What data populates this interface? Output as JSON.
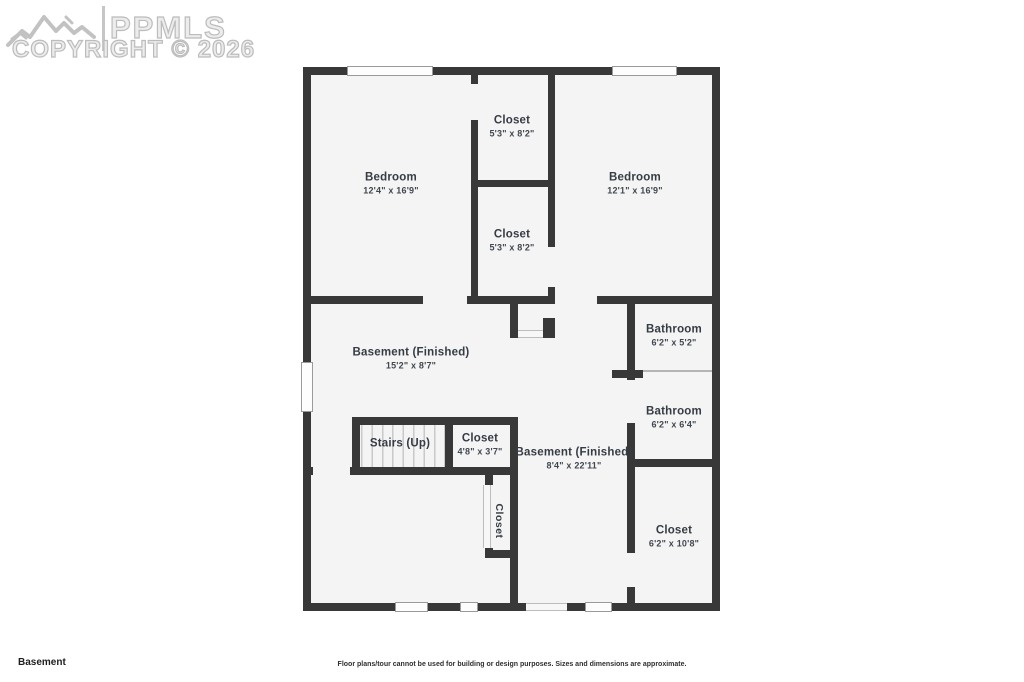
{
  "watermark": {
    "brand": "PPMLS",
    "copyright": "COPYRIGHT © 2026"
  },
  "floor_label": "Basement",
  "disclaimer": "Floor plans/tour cannot be used for building or design purposes. Sizes and dimensions are approximate.",
  "colors": {
    "wall": "#383838",
    "floor": "#f4f4f4",
    "label_text": "#363c44",
    "watermark": "#bcbcbc"
  },
  "rooms": [
    {
      "name": "Bedroom",
      "dims": "12'4\" x 16'9\""
    },
    {
      "name": "Closet",
      "dims": "5'3\" x 8'2\""
    },
    {
      "name": "Closet",
      "dims": "5'3\" x 8'2\""
    },
    {
      "name": "Bedroom",
      "dims": "12'1\" x 16'9\""
    },
    {
      "name": "Basement (Finished)",
      "dims": "15'2\" x 8'7\""
    },
    {
      "name": "Bathroom",
      "dims": "6'2\" x 5'2\""
    },
    {
      "name": "Bathroom",
      "dims": "6'2\" x 6'4\""
    },
    {
      "name": "Stairs (Up)",
      "dims": ""
    },
    {
      "name": "Closet",
      "dims": "4'8\" x 3'7\""
    },
    {
      "name": "Basement (Finished)",
      "dims": "8'4\" x 22'11\""
    },
    {
      "name": "Closet",
      "dims": "6'2\" x 10'8\""
    },
    {
      "name": "Closet",
      "dims": ""
    }
  ]
}
